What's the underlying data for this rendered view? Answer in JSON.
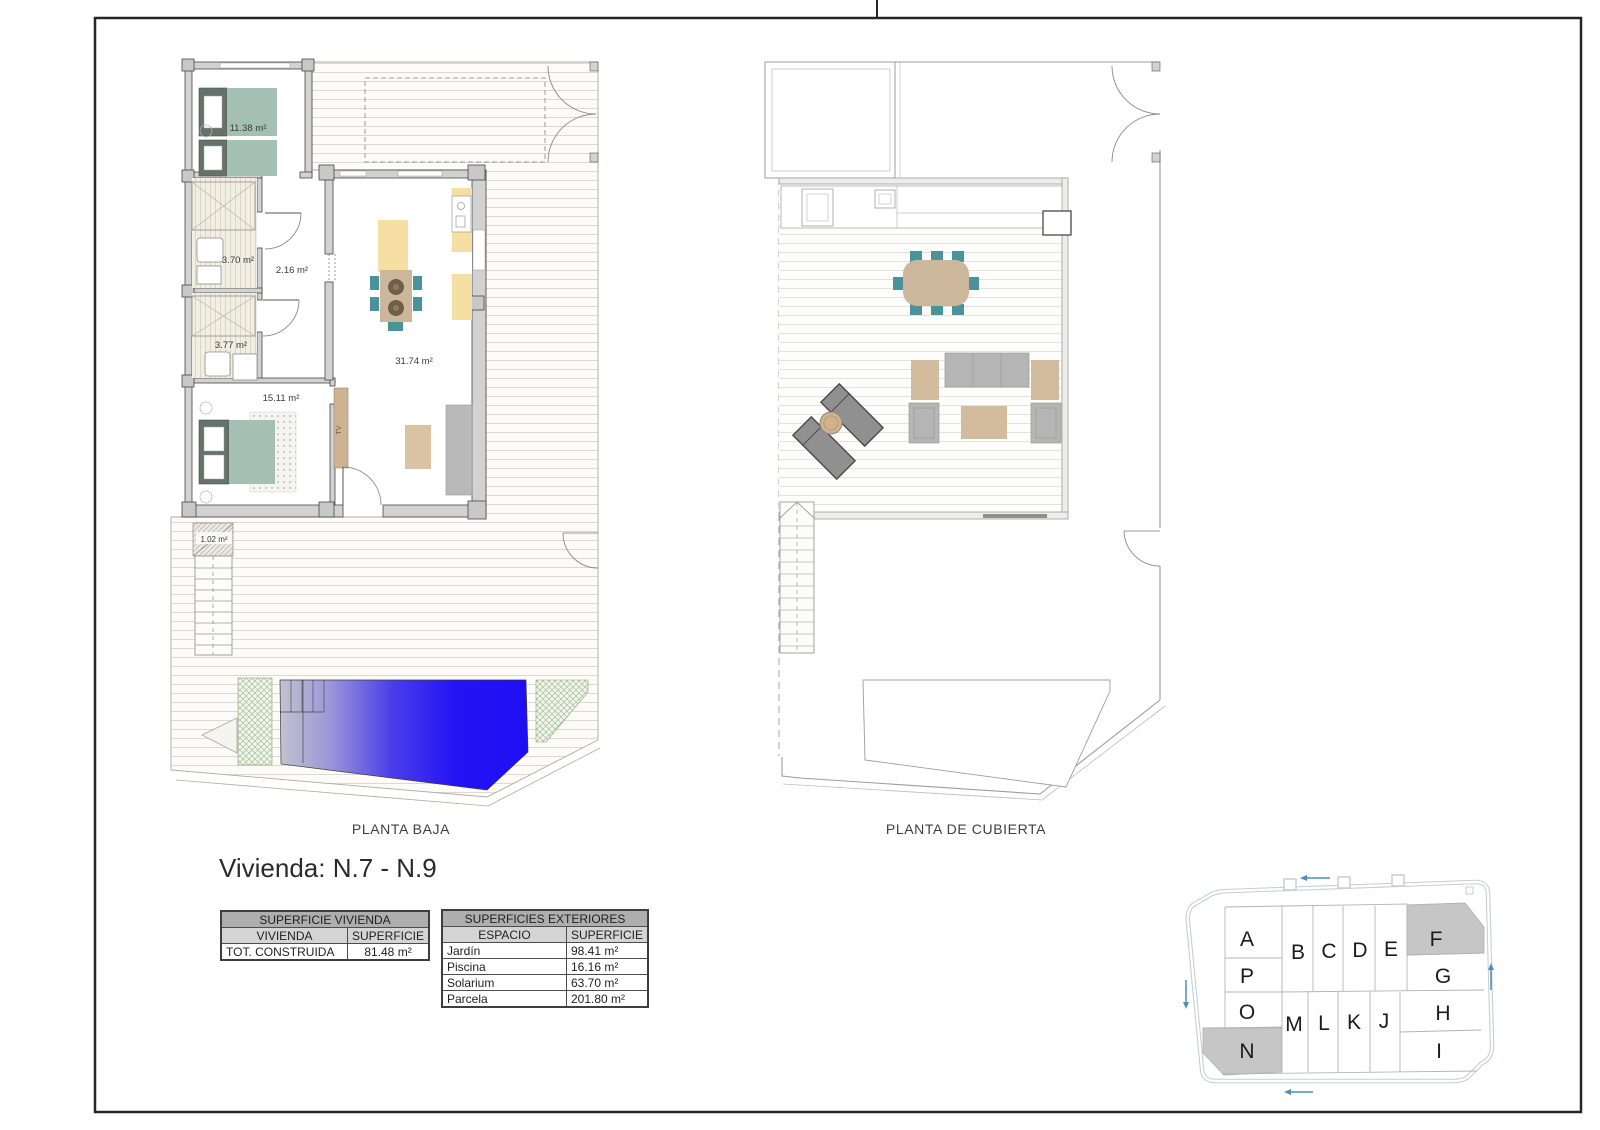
{
  "sheet": {
    "frame_color": "#262626"
  },
  "plans": {
    "ground": {
      "caption": "PLANTA BAJA",
      "rooms": [
        {
          "name": "bedroom-1",
          "area": "11.38 m²"
        },
        {
          "name": "bathroom-1",
          "area": "3.70 m²"
        },
        {
          "name": "hallway",
          "area": "2.16 m²"
        },
        {
          "name": "bathroom-2",
          "area": "3.77 m²"
        },
        {
          "name": "bedroom-2",
          "area": "15.11 m²"
        },
        {
          "name": "living-kitchen",
          "area": "31.74 m²"
        },
        {
          "name": "entry-porch",
          "area": "1.02 m²"
        }
      ],
      "tv_label": "TV"
    },
    "roof": {
      "caption": "PLANTA DE CUBIERTA"
    }
  },
  "details": {
    "title": "Vivienda: N.7 - N.9",
    "surface_table": {
      "header": "SUPERFICIE VIVIENDA",
      "col1": "VIVIENDA",
      "col2": "SUPERFICIE",
      "rows": [
        {
          "label": "TOT. CONSTRUIDA",
          "value": "81.48 m²"
        }
      ]
    },
    "exterior_table": {
      "header": "SUPERFICIES EXTERIORES",
      "col1": "ESPACIO",
      "col2": "SUPERFICIE",
      "rows": [
        {
          "label": "Jardín",
          "value": "98.41 m²"
        },
        {
          "label": "Piscina",
          "value": "16.16 m²"
        },
        {
          "label": "Solarium",
          "value": "63.70 m²"
        },
        {
          "label": "Parcela",
          "value": "201.80 m²"
        }
      ]
    }
  },
  "siteplan": {
    "plots": [
      {
        "label": "A",
        "shaded": false
      },
      {
        "label": "P",
        "shaded": false
      },
      {
        "label": "O",
        "shaded": false
      },
      {
        "label": "N",
        "shaded": true
      },
      {
        "label": "B",
        "shaded": false
      },
      {
        "label": "C",
        "shaded": false
      },
      {
        "label": "D",
        "shaded": false
      },
      {
        "label": "E",
        "shaded": false
      },
      {
        "label": "F",
        "shaded": true
      },
      {
        "label": "G",
        "shaded": false
      },
      {
        "label": "H",
        "shaded": false
      },
      {
        "label": "I",
        "shaded": false
      },
      {
        "label": "M",
        "shaded": false
      },
      {
        "label": "L",
        "shaded": false
      },
      {
        "label": "K",
        "shaded": false
      },
      {
        "label": "J",
        "shaded": false
      }
    ],
    "shaded_color": "#c6c6c6"
  },
  "colors": {
    "pool_blue": "#2110f2",
    "chair_teal": "#4b929c",
    "wood_tan": "#cdb79c",
    "bed_green": "#a3c0b2",
    "kitchen_yellow": "#f6dfa3",
    "wall_gray": "#d2d2d2",
    "site_outline": "#c5ced4",
    "arrow_blue": "#4f8fb5"
  }
}
